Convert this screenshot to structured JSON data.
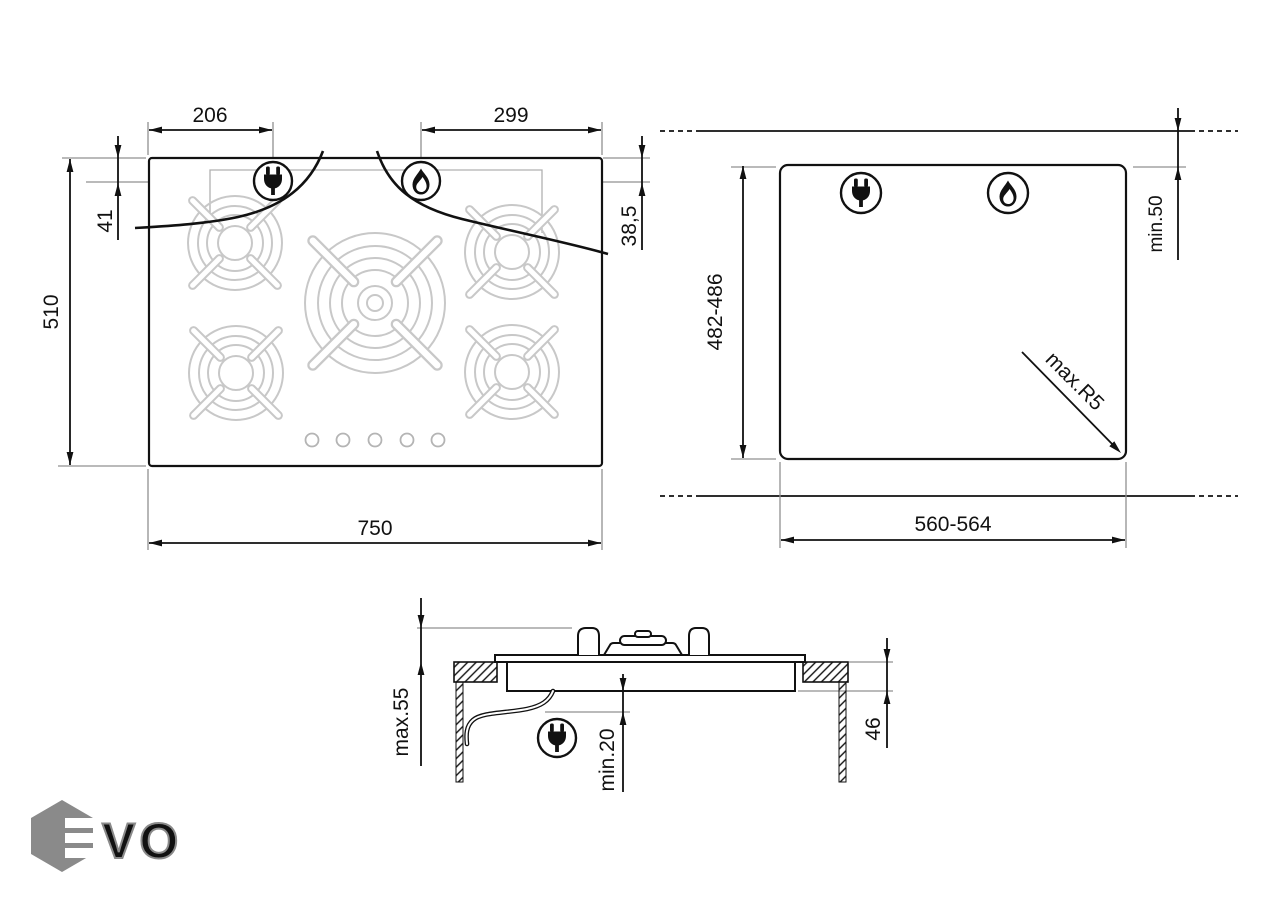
{
  "diagram": {
    "top_view": {
      "plug_offset": "206",
      "flame_offset": "299",
      "plug_inset": "41",
      "flame_inset": "38,5",
      "depth": "510",
      "width": "750"
    },
    "cutout_view": {
      "height": "482-486",
      "width": "560-564",
      "rear_clearance": "min.50",
      "corner_radius": "max.R5"
    },
    "side_view": {
      "max_height": "max.55",
      "min_clearance": "min.20",
      "recess_depth": "46"
    },
    "icons": {
      "plug": "power-plug-icon",
      "flame": "gas-flame-icon"
    },
    "colors": {
      "line": "#111111",
      "extension": "#909090",
      "grate": "#c8c8c8",
      "logo": "#8a8a8a"
    },
    "logo": {
      "text": "EVO",
      "vo": "VO"
    }
  }
}
